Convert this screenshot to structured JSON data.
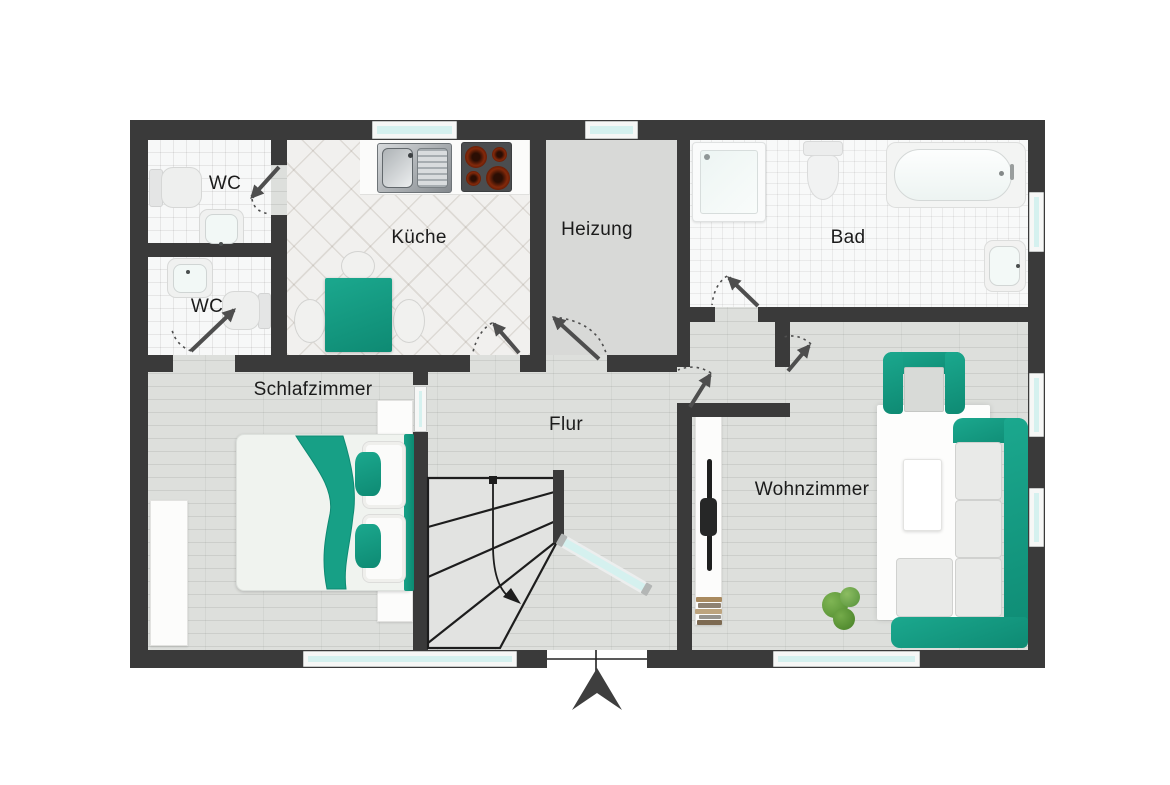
{
  "title": "Grundriss",
  "rooms": {
    "wc1": {
      "label": "WC"
    },
    "wc2": {
      "label": "WC"
    },
    "kueche": {
      "label": "Küche"
    },
    "heizung": {
      "label": "Heizung"
    },
    "bad": {
      "label": "Bad"
    },
    "schlafzimmer": {
      "label": "Schlafzimmer"
    },
    "flur": {
      "label": "Flur"
    },
    "wohnzimmer": {
      "label": "Wohnzimmer"
    }
  },
  "colors": {
    "wall": "#3a3a3a",
    "accent": "#1ba88e",
    "accent_dark": "#0e8a73",
    "glass": "#d5f1ef"
  }
}
